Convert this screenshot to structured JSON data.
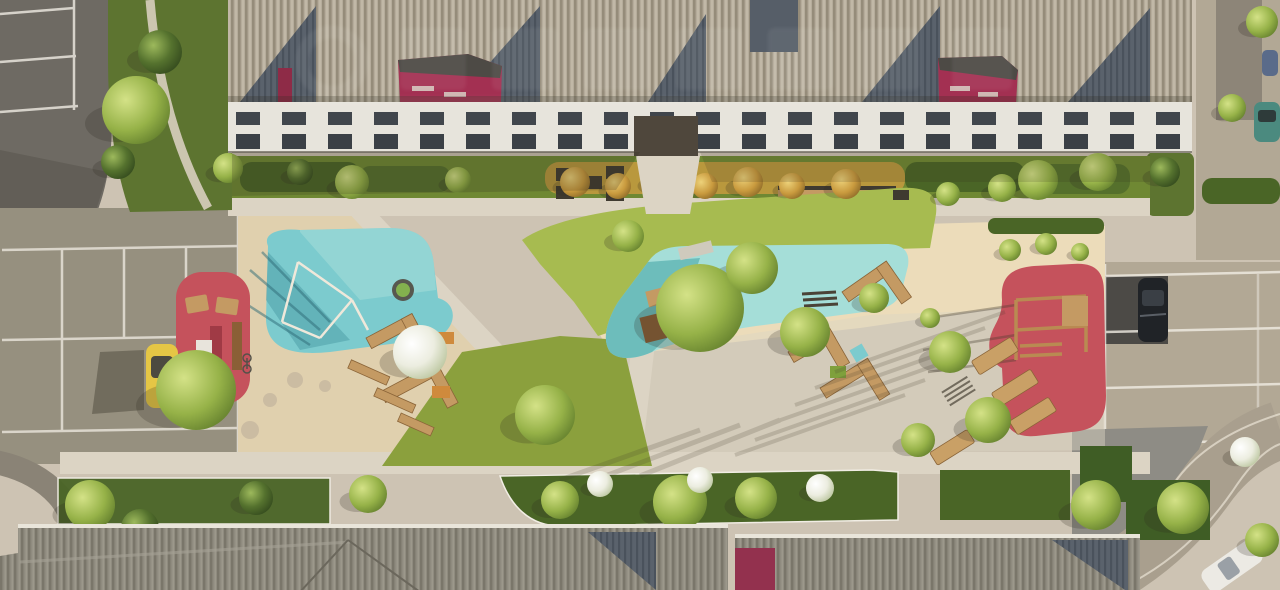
{
  "meta": {
    "title": "Aerial render of a residential complex courtyard with playgrounds, lawns, sand areas and parking",
    "view": "top-down aerial render",
    "watermark_present": true
  },
  "palette": {
    "pavement": "#cdc3b3",
    "pavementLight": "#dcd4c4",
    "sand": "#e0d0ae",
    "sandBright": "#ecdcba",
    "parkingGray": "#96907f",
    "asphaltDark": "#6e6a63",
    "asphaltPatch": "#4c4a46",
    "parkingRight": "#b2a895",
    "lineWhite": "#f1ede4",
    "grass": "#8ba03d",
    "grassBright": "#a7bb50",
    "hedge": "#4a6526",
    "verge": "#5d7430",
    "water": "#7ccbce",
    "waterLight": "#a5ded8",
    "waterShadow": "#3f8f9b",
    "playRed": "#c5525c",
    "playRedDark": "#a03a45",
    "roofRib": "#b5ac9b",
    "roofDark": "#5a626c",
    "roofBottom": "#8f8b7f",
    "facade": "#e7e4dc",
    "windowDark": "#41464c",
    "magenta": "#a33052",
    "magentaDark": "#8e2b47",
    "wood": "#c49a63",
    "woodDark": "#8a5f36",
    "shadow": "#3a3222",
    "carYellow": "#e5c645",
    "carBlack": "#202327",
    "carWhite": "#eceae4",
    "carTeal": "#4b8a7f",
    "blossom": "#f2f2e6",
    "trampolineGreen": "#83b14e",
    "paverGray": "#8e8c85"
  },
  "scene": {
    "trees": [
      {
        "x": 136,
        "y": 110,
        "r": 34,
        "kind": "light"
      },
      {
        "x": 160,
        "y": 52,
        "r": 22,
        "kind": "dark"
      },
      {
        "x": 118,
        "y": 162,
        "r": 17,
        "kind": "dark"
      },
      {
        "x": 228,
        "y": 168,
        "r": 15,
        "kind": "light"
      },
      {
        "x": 196,
        "y": 390,
        "r": 40,
        "kind": "light"
      },
      {
        "x": 352,
        "y": 182,
        "r": 17,
        "kind": "light"
      },
      {
        "x": 300,
        "y": 172,
        "r": 13,
        "kind": "dark"
      },
      {
        "x": 458,
        "y": 180,
        "r": 13,
        "kind": "light"
      },
      {
        "x": 420,
        "y": 352,
        "r": 27,
        "kind": "blossom"
      },
      {
        "x": 545,
        "y": 415,
        "r": 30,
        "kind": "light"
      },
      {
        "x": 700,
        "y": 308,
        "r": 44,
        "kind": "light"
      },
      {
        "x": 752,
        "y": 268,
        "r": 26,
        "kind": "light"
      },
      {
        "x": 628,
        "y": 236,
        "r": 16,
        "kind": "light"
      },
      {
        "x": 805,
        "y": 332,
        "r": 25,
        "kind": "light"
      },
      {
        "x": 874,
        "y": 298,
        "r": 15,
        "kind": "light"
      },
      {
        "x": 950,
        "y": 352,
        "r": 21,
        "kind": "light"
      },
      {
        "x": 988,
        "y": 420,
        "r": 23,
        "kind": "light"
      },
      {
        "x": 918,
        "y": 440,
        "r": 17,
        "kind": "light"
      },
      {
        "x": 575,
        "y": 182,
        "r": 15,
        "kind": "gold"
      },
      {
        "x": 618,
        "y": 186,
        "r": 13,
        "kind": "gold"
      },
      {
        "x": 660,
        "y": 180,
        "r": 15,
        "kind": "gold"
      },
      {
        "x": 705,
        "y": 186,
        "r": 13,
        "kind": "gold"
      },
      {
        "x": 748,
        "y": 182,
        "r": 15,
        "kind": "gold"
      },
      {
        "x": 792,
        "y": 186,
        "r": 13,
        "kind": "gold"
      },
      {
        "x": 846,
        "y": 184,
        "r": 15,
        "kind": "gold"
      },
      {
        "x": 948,
        "y": 194,
        "r": 12,
        "kind": "light"
      },
      {
        "x": 1002,
        "y": 188,
        "r": 14,
        "kind": "light"
      },
      {
        "x": 1038,
        "y": 180,
        "r": 20,
        "kind": "light"
      },
      {
        "x": 1098,
        "y": 172,
        "r": 19,
        "kind": "light"
      },
      {
        "x": 1165,
        "y": 172,
        "r": 15,
        "kind": "dark"
      },
      {
        "x": 1232,
        "y": 108,
        "r": 14,
        "kind": "light"
      },
      {
        "x": 1262,
        "y": 22,
        "r": 16,
        "kind": "light"
      },
      {
        "x": 1010,
        "y": 250,
        "r": 11,
        "kind": "light"
      },
      {
        "x": 1046,
        "y": 244,
        "r": 11,
        "kind": "light"
      },
      {
        "x": 1080,
        "y": 252,
        "r": 9,
        "kind": "light"
      },
      {
        "x": 930,
        "y": 318,
        "r": 10,
        "kind": "light"
      },
      {
        "x": 90,
        "y": 505,
        "r": 25,
        "kind": "light"
      },
      {
        "x": 140,
        "y": 528,
        "r": 19,
        "kind": "dark"
      },
      {
        "x": 256,
        "y": 498,
        "r": 17,
        "kind": "dark"
      },
      {
        "x": 368,
        "y": 494,
        "r": 19,
        "kind": "light"
      },
      {
        "x": 560,
        "y": 500,
        "r": 19,
        "kind": "light"
      },
      {
        "x": 680,
        "y": 502,
        "r": 27,
        "kind": "light"
      },
      {
        "x": 756,
        "y": 498,
        "r": 21,
        "kind": "light"
      },
      {
        "x": 600,
        "y": 484,
        "r": 13,
        "kind": "blossom"
      },
      {
        "x": 700,
        "y": 480,
        "r": 13,
        "kind": "blossom"
      },
      {
        "x": 820,
        "y": 488,
        "r": 14,
        "kind": "blossom"
      },
      {
        "x": 1096,
        "y": 505,
        "r": 25,
        "kind": "light"
      },
      {
        "x": 1183,
        "y": 508,
        "r": 26,
        "kind": "light"
      },
      {
        "x": 1245,
        "y": 452,
        "r": 15,
        "kind": "blossom"
      },
      {
        "x": 1262,
        "y": 540,
        "r": 17,
        "kind": "light"
      }
    ]
  }
}
